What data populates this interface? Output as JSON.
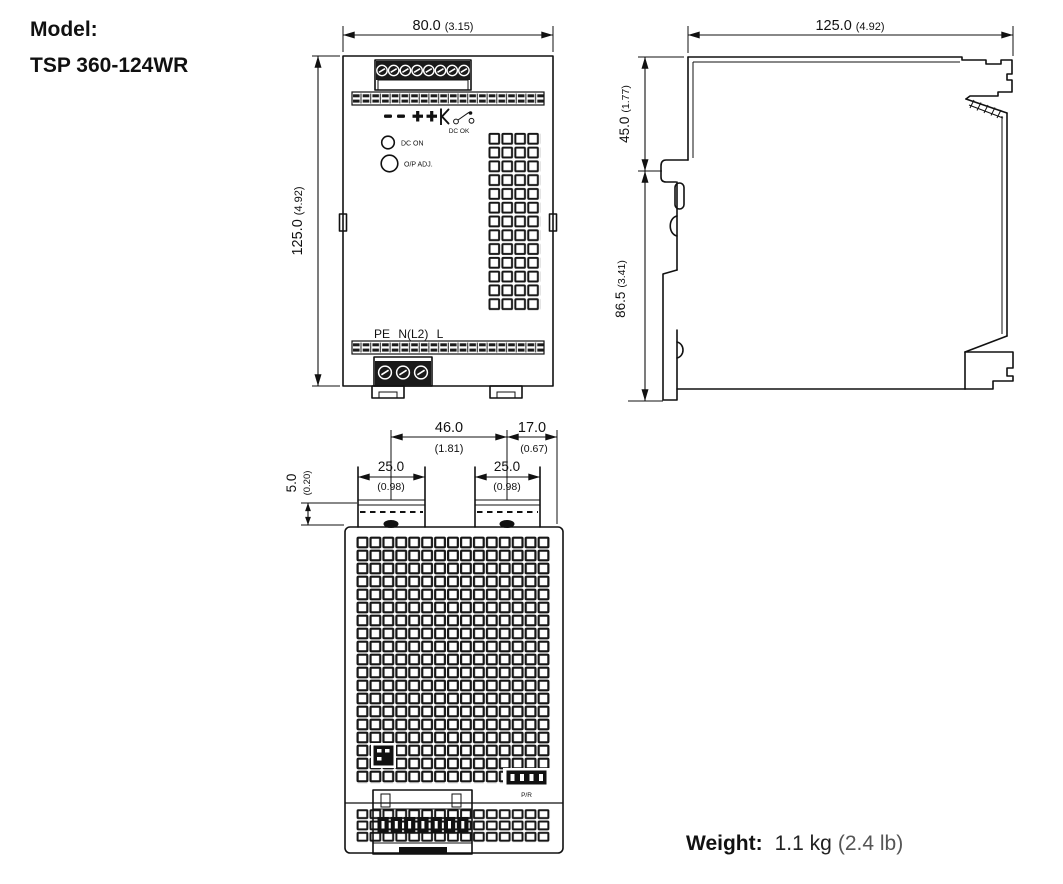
{
  "model": {
    "label": "Model:",
    "value": "TSP 360-124WR"
  },
  "weight": {
    "label": "Weight:",
    "metric": "1.1 kg",
    "imperial": "(2.4 lb)"
  },
  "front_view": {
    "dim_width": {
      "mm": "80.0",
      "inch": "(3.15)"
    },
    "dim_height": {
      "mm": "125.0",
      "inch": "(4.92)"
    },
    "labels": {
      "dc_ok": "DC OK",
      "dc_on": "DC ON",
      "output_adjust": "O/P ADJ.",
      "input_terminals": "PE N(L2) L"
    }
  },
  "side_view": {
    "dim_width": {
      "mm": "125.0",
      "inch": "(4.92)"
    },
    "dim_upper": {
      "mm": "45.0",
      "inch": "(1.77)"
    },
    "dim_lower": {
      "mm": "86.5",
      "inch": "(3.41)"
    }
  },
  "bottom_view": {
    "dim_feet_span": {
      "mm": "46.0",
      "inch": "(1.81)"
    },
    "dim_edge_offset": {
      "mm": "17.0",
      "inch": "(0.67)"
    },
    "dim_foot_left": {
      "mm": "25.0",
      "inch": "(0.98)"
    },
    "dim_foot_right": {
      "mm": "25.0",
      "inch": "(0.98)"
    },
    "dim_rail_depth": {
      "mm": "5.0",
      "inch": "(0.20)"
    },
    "labels": {
      "aux_connector": "P/R"
    }
  }
}
